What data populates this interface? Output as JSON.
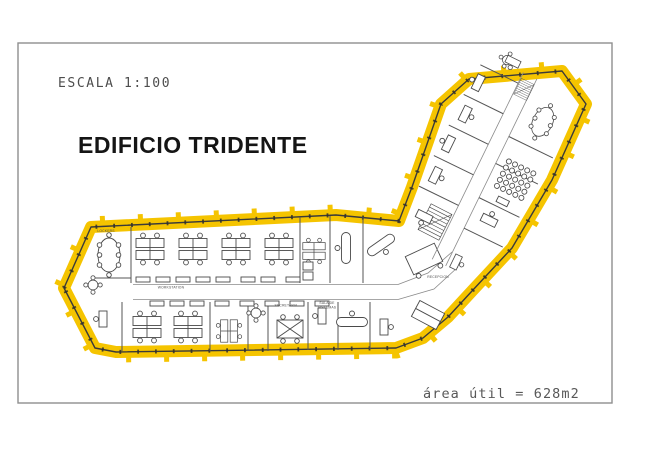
{
  "page": {
    "scale_label": "ESCALA 1:100",
    "title": "EDIFICIO TRIDENTE",
    "area_label": "área útil = 628m2"
  },
  "floorplan": {
    "building_name": "EDIFICIO TRIDENTE",
    "room_labels": {
      "workstation": "WORKSTATION",
      "reception": "RECEPCION",
      "secretaria": "SECRETARIA",
      "sala_sistemas_line1": "SALA DE",
      "sala_sistemas_line2": "SISTEMAS",
      "lockers": "LOCKERS"
    },
    "colors": {
      "highlight": "#F5C400",
      "wall": "#3a3a3a",
      "furniture": "#4a4a4a",
      "frame": "#8f8f8f"
    }
  }
}
